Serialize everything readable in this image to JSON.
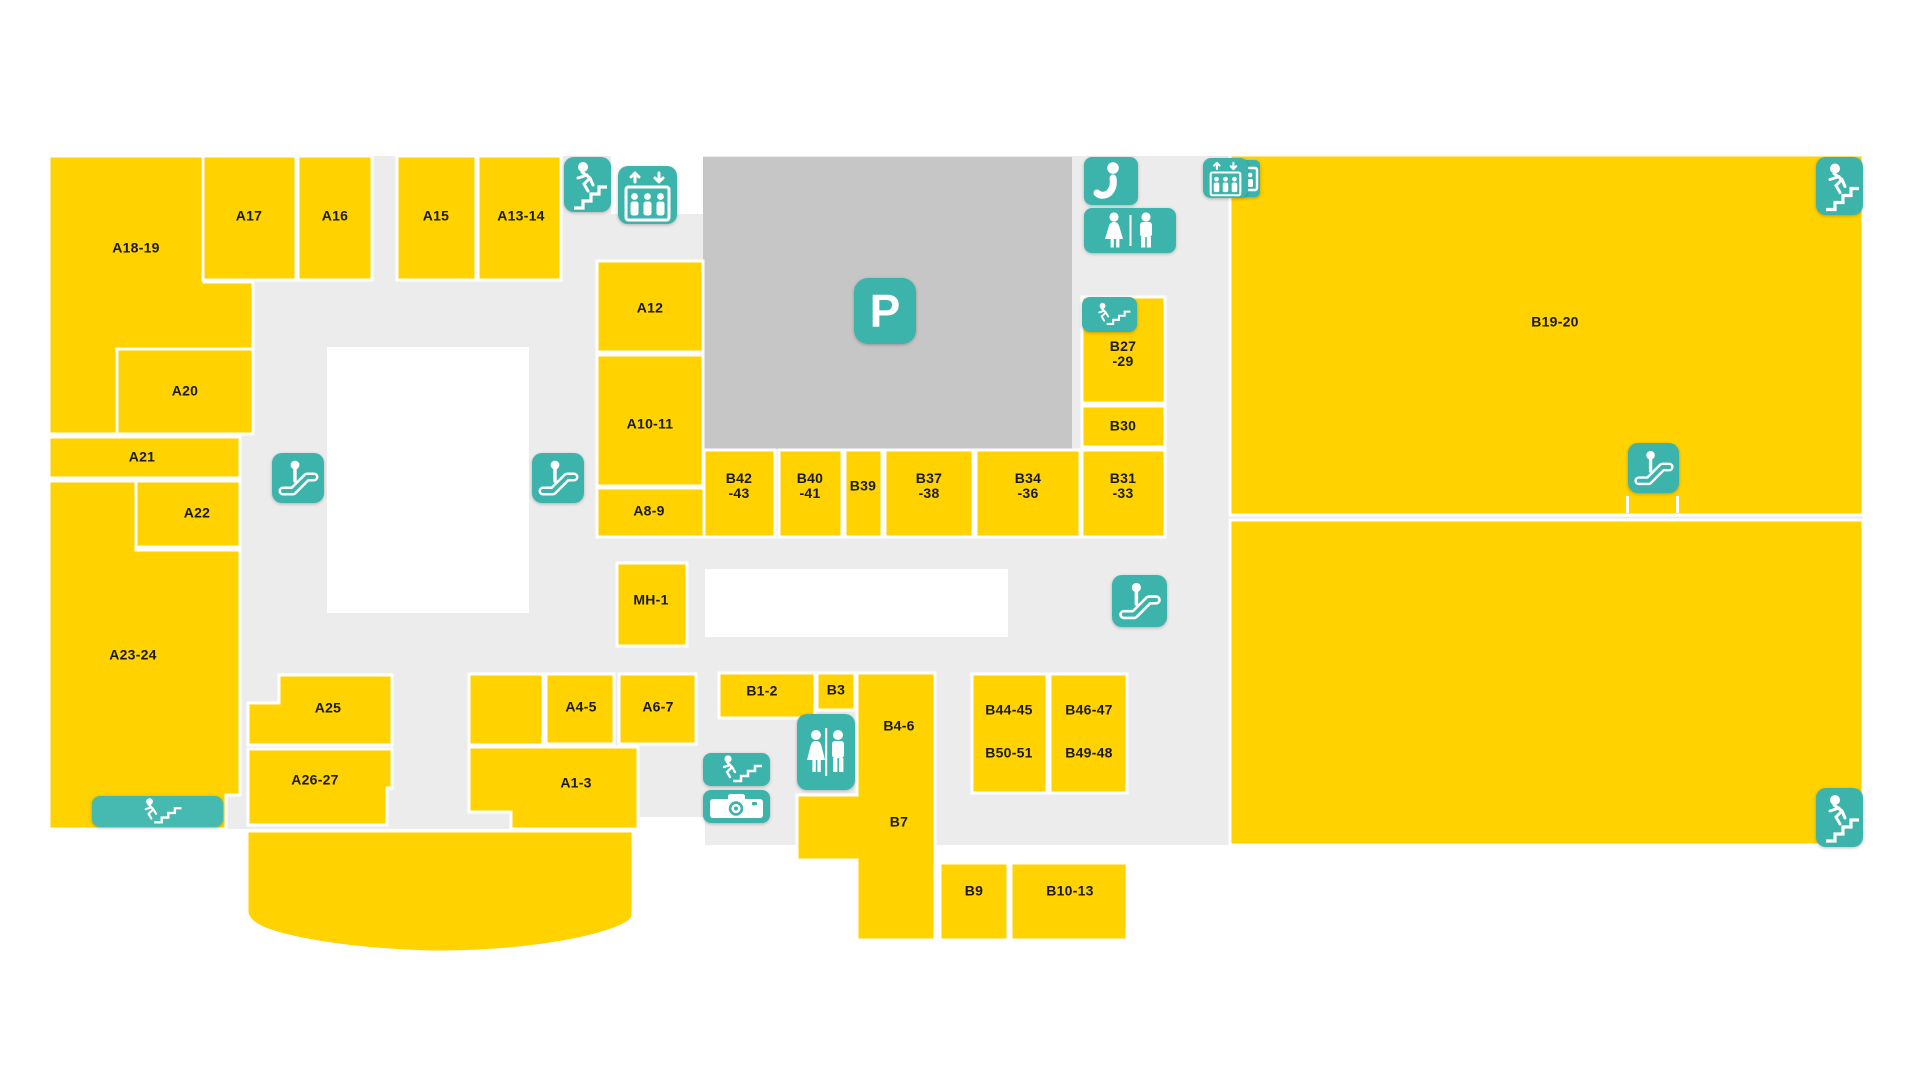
{
  "map": {
    "title": "Mall floor plan",
    "colors": {
      "store": "#FFD200",
      "floor": "#ECECEC",
      "parking": "#C6C6C6",
      "icon": "#3CB4AB",
      "icon_light": "#46B9B0",
      "divider": "#FFFFFF",
      "label_text": "#1A1A1A"
    },
    "floor": {
      "rects": [
        {
          "x": 49,
          "y": 156,
          "w": 591,
          "h": 673
        },
        {
          "x": 640,
          "y": 156,
          "w": 1223,
          "h": 689
        }
      ],
      "cutouts": [
        {
          "x": 327,
          "y": 347,
          "w": 202,
          "h": 266
        },
        {
          "x": 705,
          "y": 569,
          "w": 303,
          "h": 68
        },
        {
          "x": 611,
          "y": 156,
          "w": 92,
          "h": 58
        },
        {
          "x": 640,
          "y": 817,
          "w": 65,
          "h": 28
        }
      ]
    },
    "parking": {
      "x": 703,
      "y": 157,
      "w": 369,
      "h": 292
    },
    "marks": [
      {
        "x": 1626,
        "y": 496,
        "w": 3,
        "h": 17
      },
      {
        "x": 1676,
        "y": 496,
        "w": 3,
        "h": 17
      }
    ],
    "stores": [
      {
        "id": "A18-19",
        "shape": "path",
        "d": "M49 156 H204 V282 H253 V349 H117 V434 H49 Z"
      },
      {
        "id": "A17",
        "x": 203,
        "y": 156,
        "w": 93,
        "h": 124
      },
      {
        "id": "A16",
        "x": 298,
        "y": 156,
        "w": 74,
        "h": 124
      },
      {
        "id": "A15",
        "x": 397,
        "y": 156,
        "w": 79,
        "h": 124
      },
      {
        "id": "A13-14",
        "x": 478,
        "y": 156,
        "w": 83,
        "h": 124
      },
      {
        "id": "A20",
        "x": 117,
        "y": 349,
        "w": 136,
        "h": 85
      },
      {
        "id": "A21",
        "x": 49,
        "y": 437,
        "w": 191,
        "h": 41
      },
      {
        "id": "A22",
        "x": 136,
        "y": 481,
        "w": 104,
        "h": 66
      },
      {
        "id": "A23-24",
        "shape": "path",
        "d": "M49 481 H136 V550 H240 V795 H226 V829 H49 Z"
      },
      {
        "id": "A12",
        "x": 597,
        "y": 261,
        "w": 106,
        "h": 91
      },
      {
        "id": "A10-11",
        "x": 597,
        "y": 355,
        "w": 106,
        "h": 131
      },
      {
        "id": "A8-9",
        "x": 597,
        "y": 488,
        "w": 107,
        "h": 49
      },
      {
        "id": "MH-1",
        "x": 617,
        "y": 563,
        "w": 70,
        "h": 83
      },
      {
        "id": "A25",
        "shape": "path",
        "d": "M279 675 H392 V745 H248 V703 H279 Z"
      },
      {
        "id": "A26-27",
        "shape": "path",
        "d": "M248 749 H392 V788 H387 V825 H248 Z"
      },
      {
        "id": "food-curve",
        "shape": "path",
        "d": "M247 831 H633 V915 C633 923 612 932 573 940 C524 950 452 954 408 951 C341 948 287 938 263 928 C251 922 247 917 247 911 Z"
      },
      {
        "id": "unlabeled",
        "x": 469,
        "y": 674,
        "w": 74,
        "h": 71
      },
      {
        "id": "A4-5",
        "x": 546,
        "y": 674,
        "w": 68,
        "h": 70
      },
      {
        "id": "A6-7",
        "x": 619,
        "y": 674,
        "w": 77,
        "h": 70
      },
      {
        "id": "A1-3",
        "shape": "path",
        "d": "M469 747 H638 V829 H511 V812 H469 Z"
      },
      {
        "id": "B42-43",
        "x": 704,
        "y": 450,
        "w": 71,
        "h": 87
      },
      {
        "id": "B40-41",
        "x": 779,
        "y": 450,
        "w": 63,
        "h": 87
      },
      {
        "id": "B39",
        "x": 845,
        "y": 450,
        "w": 37,
        "h": 87
      },
      {
        "id": "B37-38",
        "x": 885,
        "y": 450,
        "w": 88,
        "h": 87
      },
      {
        "id": "B34-36",
        "x": 976,
        "y": 450,
        "w": 104,
        "h": 87
      },
      {
        "id": "B31-33",
        "x": 1082,
        "y": 450,
        "w": 83,
        "h": 87
      },
      {
        "id": "B30",
        "x": 1082,
        "y": 406,
        "w": 83,
        "h": 41
      },
      {
        "id": "B27-29",
        "x": 1082,
        "y": 297,
        "w": 83,
        "h": 106
      },
      {
        "id": "B19-20",
        "x": 1230,
        "y": 155,
        "w": 633,
        "h": 360
      },
      {
        "id": "B19-20-lower",
        "x": 1230,
        "y": 520,
        "w": 633,
        "h": 325
      },
      {
        "id": "B1-2",
        "x": 719,
        "y": 673,
        "w": 96,
        "h": 45
      },
      {
        "id": "B3",
        "x": 817,
        "y": 673,
        "w": 38,
        "h": 37
      },
      {
        "id": "B4-6-B7",
        "shape": "path",
        "d": "M857 673 H935 V940 H857 V860 H797 V795 H857 Z"
      },
      {
        "id": "B9",
        "x": 940,
        "y": 863,
        "w": 68,
        "h": 77
      },
      {
        "id": "B10-13",
        "x": 1011,
        "y": 863,
        "w": 116,
        "h": 77
      },
      {
        "id": "B44-45-B50-51",
        "x": 972,
        "y": 674,
        "w": 75,
        "h": 119
      },
      {
        "id": "B46-47-B49-48",
        "x": 1050,
        "y": 674,
        "w": 77,
        "h": 119
      }
    ],
    "labels": [
      {
        "text": "A18-19",
        "x": 136,
        "y": 248
      },
      {
        "text": "A17",
        "x": 249,
        "y": 216
      },
      {
        "text": "A16",
        "x": 335,
        "y": 216
      },
      {
        "text": "A15",
        "x": 436,
        "y": 216
      },
      {
        "text": "A13-14",
        "x": 521,
        "y": 216
      },
      {
        "text": "A20",
        "x": 185,
        "y": 391
      },
      {
        "text": "A21",
        "x": 142,
        "y": 457
      },
      {
        "text": "A22",
        "x": 197,
        "y": 513
      },
      {
        "text": "A23-24",
        "x": 133,
        "y": 655
      },
      {
        "text": "A12",
        "x": 650,
        "y": 308
      },
      {
        "text": "A10-11",
        "x": 650,
        "y": 424
      },
      {
        "text": "A8-9",
        "x": 649,
        "y": 511
      },
      {
        "text": "MH-1",
        "x": 651,
        "y": 600
      },
      {
        "text": "A25",
        "x": 328,
        "y": 708
      },
      {
        "text": "A26-27",
        "x": 315,
        "y": 780
      },
      {
        "text": "A4-5",
        "x": 581,
        "y": 707
      },
      {
        "text": "A6-7",
        "x": 658,
        "y": 707
      },
      {
        "text": "A1-3",
        "x": 576,
        "y": 783
      },
      {
        "text": "B42\n-43",
        "x": 739,
        "y": 486
      },
      {
        "text": "B40\n-41",
        "x": 810,
        "y": 486
      },
      {
        "text": "B39",
        "x": 863,
        "y": 486
      },
      {
        "text": "B37\n-38",
        "x": 929,
        "y": 486
      },
      {
        "text": "B34\n-36",
        "x": 1028,
        "y": 486
      },
      {
        "text": "B31\n-33",
        "x": 1123,
        "y": 486
      },
      {
        "text": "B27\n-29",
        "x": 1123,
        "y": 354
      },
      {
        "text": "B30",
        "x": 1123,
        "y": 426
      },
      {
        "text": "B19-20",
        "x": 1555,
        "y": 322
      },
      {
        "text": "B1-2",
        "x": 762,
        "y": 691
      },
      {
        "text": "B3",
        "x": 836,
        "y": 690
      },
      {
        "text": "B4-6",
        "x": 899,
        "y": 726
      },
      {
        "text": "B7",
        "x": 899,
        "y": 822
      },
      {
        "text": "B9",
        "x": 974,
        "y": 891
      },
      {
        "text": "B10-13",
        "x": 1070,
        "y": 891
      },
      {
        "text": "B44-45",
        "x": 1009,
        "y": 710
      },
      {
        "text": "B50-51",
        "x": 1009,
        "y": 753
      },
      {
        "text": "B46-47",
        "x": 1089,
        "y": 710
      },
      {
        "text": "B49-48",
        "x": 1089,
        "y": 753
      }
    ],
    "icons": [
      {
        "name": "stairs-icon",
        "glyph": "stairs",
        "x": 564,
        "y": 157,
        "w": 47,
        "h": 55,
        "r": 10
      },
      {
        "name": "elevator-icon",
        "glyph": "elevator",
        "x": 618,
        "y": 166,
        "w": 59,
        "h": 58,
        "r": 10
      },
      {
        "name": "parking-icon",
        "glyph": "p",
        "x": 854,
        "y": 278,
        "w": 62,
        "h": 66,
        "r": 14
      },
      {
        "name": "information-icon",
        "glyph": "info",
        "x": 1084,
        "y": 157,
        "w": 54,
        "h": 48,
        "r": 8
      },
      {
        "name": "restroom-icon",
        "glyph": "wc_wide",
        "x": 1084,
        "y": 208,
        "w": 92,
        "h": 45,
        "r": 8
      },
      {
        "name": "elevator-back-icon",
        "glyph": "elevator_back",
        "x": 1240,
        "y": 160,
        "w": 20,
        "h": 37,
        "r": 5
      },
      {
        "name": "elevator-icon",
        "glyph": "elevator",
        "x": 1203,
        "y": 158,
        "w": 45,
        "h": 40,
        "r": 8
      },
      {
        "name": "stairs-icon",
        "glyph": "stairs_wide",
        "x": 1082,
        "y": 297,
        "w": 55,
        "h": 35,
        "r": 8
      },
      {
        "name": "escalator-icon",
        "glyph": "escalator",
        "x": 272,
        "y": 453,
        "w": 52,
        "h": 50,
        "r": 10
      },
      {
        "name": "escalator-icon",
        "glyph": "escalator",
        "x": 532,
        "y": 453,
        "w": 52,
        "h": 50,
        "r": 10
      },
      {
        "name": "escalator-icon",
        "glyph": "escalator",
        "x": 1112,
        "y": 575,
        "w": 55,
        "h": 52,
        "r": 10
      },
      {
        "name": "escalator-icon",
        "glyph": "escalator",
        "x": 1628,
        "y": 443,
        "w": 51,
        "h": 50,
        "r": 10
      },
      {
        "name": "stairs-icon",
        "glyph": "stairs",
        "x": 1816,
        "y": 157,
        "w": 47,
        "h": 58,
        "r": 10
      },
      {
        "name": "stairs-icon",
        "glyph": "stairs",
        "x": 1816,
        "y": 788,
        "w": 47,
        "h": 59,
        "r": 10
      },
      {
        "name": "stairs-icon",
        "glyph": "stairs_wide",
        "x": 92,
        "y": 796,
        "w": 131,
        "h": 31,
        "r": 8,
        "light": true
      },
      {
        "name": "stairs-icon",
        "glyph": "stairs_wide",
        "x": 703,
        "y": 753,
        "w": 67,
        "h": 33,
        "r": 8
      },
      {
        "name": "camera-icon",
        "glyph": "camera",
        "x": 703,
        "y": 790,
        "w": 67,
        "h": 33,
        "r": 8
      },
      {
        "name": "restroom-icon",
        "glyph": "wc_tall",
        "x": 797,
        "y": 714,
        "w": 58,
        "h": 76,
        "r": 10
      }
    ]
  }
}
